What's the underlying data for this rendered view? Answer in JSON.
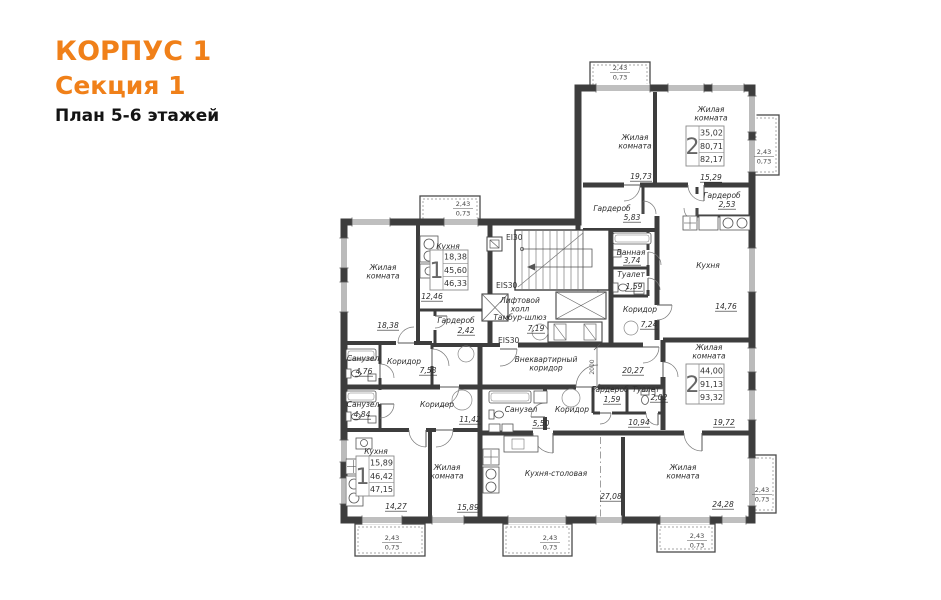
{
  "header": {
    "building": "КОРПУС 1",
    "section": "Секция 1",
    "plan_title": "План 5-6 этажей",
    "accent_color": "#f08019"
  },
  "plan": {
    "room_labels": [
      {
        "lines": [
          "Жилая",
          "комната"
        ],
        "x": 383,
        "y": 270,
        "area": "18,38",
        "ax": 388,
        "ay": 328
      },
      {
        "lines": [
          "Кухня"
        ],
        "x": 448,
        "y": 249,
        "area": "12,46",
        "ax": 432,
        "ay": 299
      },
      {
        "lines": [
          "Гардероб"
        ],
        "x": 456,
        "y": 323,
        "area": "2,42",
        "ax": 466,
        "ay": 333
      },
      {
        "lines": [
          "Санузел"
        ],
        "x": 363,
        "y": 361,
        "area": "4,76",
        "ax": 364,
        "ay": 374
      },
      {
        "lines": [
          "Коридор"
        ],
        "x": 404,
        "y": 364,
        "area": "7,58",
        "ax": 428,
        "ay": 373
      },
      {
        "lines": [
          "Санузел"
        ],
        "x": 363,
        "y": 407,
        "area": "4,84",
        "ax": 362,
        "ay": 417
      },
      {
        "lines": [
          "Коридор"
        ],
        "x": 437,
        "y": 407,
        "area": "11,42",
        "ax": 470,
        "ay": 422
      },
      {
        "lines": [
          "Кухня"
        ],
        "x": 376,
        "y": 454,
        "area": "14,27",
        "ax": 396,
        "ay": 509
      },
      {
        "lines": [
          "Жилая",
          "комната"
        ],
        "x": 447,
        "y": 470,
        "area": "15,89",
        "ax": 468,
        "ay": 510
      },
      {
        "lines": [
          "Кухня-столовая"
        ],
        "x": 556,
        "y": 476,
        "area": "27,08",
        "ax": 611,
        "ay": 499
      },
      {
        "lines": [
          "Санузел"
        ],
        "x": 521,
        "y": 412,
        "area": "5,50",
        "ax": 541,
        "ay": 426
      },
      {
        "lines": [
          "Коридор"
        ],
        "x": 572,
        "y": 412
      },
      {
        "area": "10,94",
        "ax": 639,
        "ay": 425
      },
      {
        "lines": [
          "Гардероб"
        ],
        "x": 610,
        "y": 392,
        "area": "1,59",
        "ax": 612,
        "ay": 402
      },
      {
        "lines": [
          "Туалет"
        ],
        "x": 646,
        "y": 392,
        "area": "2,02",
        "ax": 659,
        "ay": 400
      },
      {
        "lines": [
          "Жилая",
          "комната"
        ],
        "x": 709,
        "y": 350,
        "area": "19,72",
        "ax": 724,
        "ay": 425
      },
      {
        "lines": [
          "Жилая",
          "комната"
        ],
        "x": 683,
        "y": 470,
        "area": "24,28",
        "ax": 723,
        "ay": 507
      },
      {
        "lines": [
          "Жилая",
          "комната"
        ],
        "x": 635,
        "y": 140,
        "area": "19,73",
        "ax": 641,
        "ay": 179
      },
      {
        "lines": [
          "Жилая",
          "комната"
        ],
        "x": 711,
        "y": 112,
        "area": "15,29",
        "ax": 711,
        "ay": 180
      },
      {
        "lines": [
          "Гардероб"
        ],
        "x": 612,
        "y": 211,
        "area": "5,83",
        "ax": 632,
        "ay": 220
      },
      {
        "lines": [
          "Гардероб"
        ],
        "x": 722,
        "y": 198,
        "area": "2,53",
        "ax": 727,
        "ay": 207
      },
      {
        "lines": [
          "Ванная"
        ],
        "x": 631,
        "y": 255,
        "area": "3,74",
        "ax": 632,
        "ay": 263
      },
      {
        "lines": [
          "Туалет"
        ],
        "x": 631,
        "y": 277,
        "area": "1,59",
        "ax": 634,
        "ay": 289
      },
      {
        "lines": [
          "Коридор"
        ],
        "x": 640,
        "y": 312,
        "area": "7,24",
        "ax": 649,
        "ay": 327
      },
      {
        "lines": [
          "Кухня"
        ],
        "x": 708,
        "y": 268,
        "area": "14,76",
        "ax": 726,
        "ay": 309
      },
      {
        "lines": [
          "Лифтовой",
          "холл",
          "Тамбур-шлюз"
        ],
        "x": 520,
        "y": 303,
        "area": "7,19",
        "ax": 536,
        "ay": 331
      },
      {
        "lines": [
          "Внеквартирный",
          "коридор"
        ],
        "x": 546,
        "y": 362,
        "area": "20,27",
        "ax": 633,
        "ay": 373
      }
    ],
    "fire_labels": [
      {
        "text": "EI30",
        "x": 506,
        "y": 240
      },
      {
        "text": "EIS30",
        "x": 496,
        "y": 288
      },
      {
        "text": "EIS30",
        "x": 498,
        "y": 343
      }
    ],
    "stat_tables": [
      {
        "x": 430,
        "y": 250,
        "rooms": "1",
        "values": [
          "18,38",
          "45,60",
          "46,33"
        ]
      },
      {
        "x": 686,
        "y": 126,
        "rooms": "2",
        "values": [
          "35,02",
          "80,71",
          "82,17"
        ]
      },
      {
        "x": 686,
        "y": 364,
        "rooms": "2",
        "values": [
          "44,00",
          "91,13",
          "93,32"
        ]
      },
      {
        "x": 356,
        "y": 456,
        "rooms": "1",
        "values": [
          "15,89",
          "46,42",
          "47,15"
        ]
      }
    ],
    "balcony_labels": [
      {
        "top": "2,43",
        "bottom": "0,73",
        "x": 620,
        "y": 70
      },
      {
        "top": "2,43",
        "bottom": "0,73",
        "x": 463,
        "y": 206
      },
      {
        "top": "2,43",
        "bottom": "0,73",
        "x": 764,
        "y": 154
      },
      {
        "top": "2,43",
        "bottom": "0,73",
        "x": 762,
        "y": 492
      },
      {
        "top": "2,43",
        "bottom": "0,73",
        "x": 392,
        "y": 540
      },
      {
        "top": "2,43",
        "bottom": "0,73",
        "x": 550,
        "y": 540
      },
      {
        "top": "2,43",
        "bottom": "0,73",
        "x": 697,
        "y": 538
      }
    ],
    "dim_labels": [
      {
        "text": "2000",
        "x": 594,
        "y": 367,
        "rotate": -90
      }
    ]
  }
}
